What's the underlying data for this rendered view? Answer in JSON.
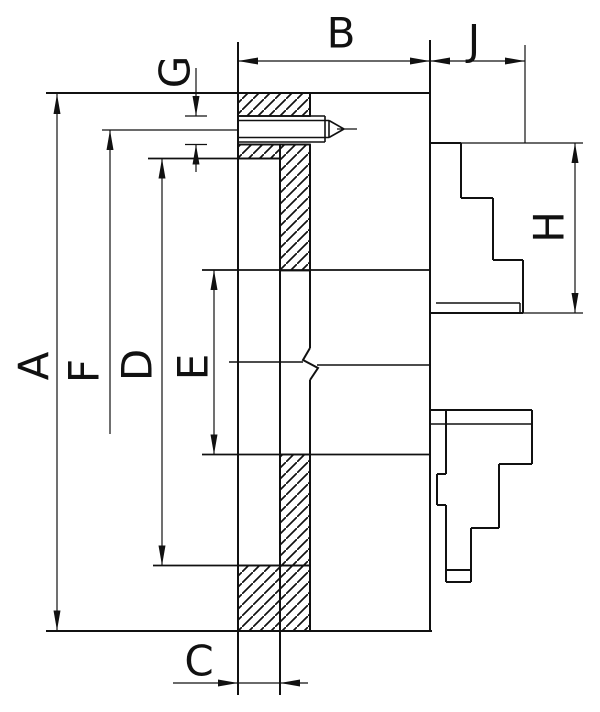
{
  "drawing": {
    "kind": "dimensioned technical drawing of a lathe chuck cross-section",
    "ink_color": "#111111",
    "background_color": "#ffffff",
    "labels": {
      "a": "A",
      "b": "B",
      "c": "C",
      "d": "D",
      "e": "E",
      "f": "F",
      "g": "G",
      "h": "H",
      "j": "J"
    }
  }
}
